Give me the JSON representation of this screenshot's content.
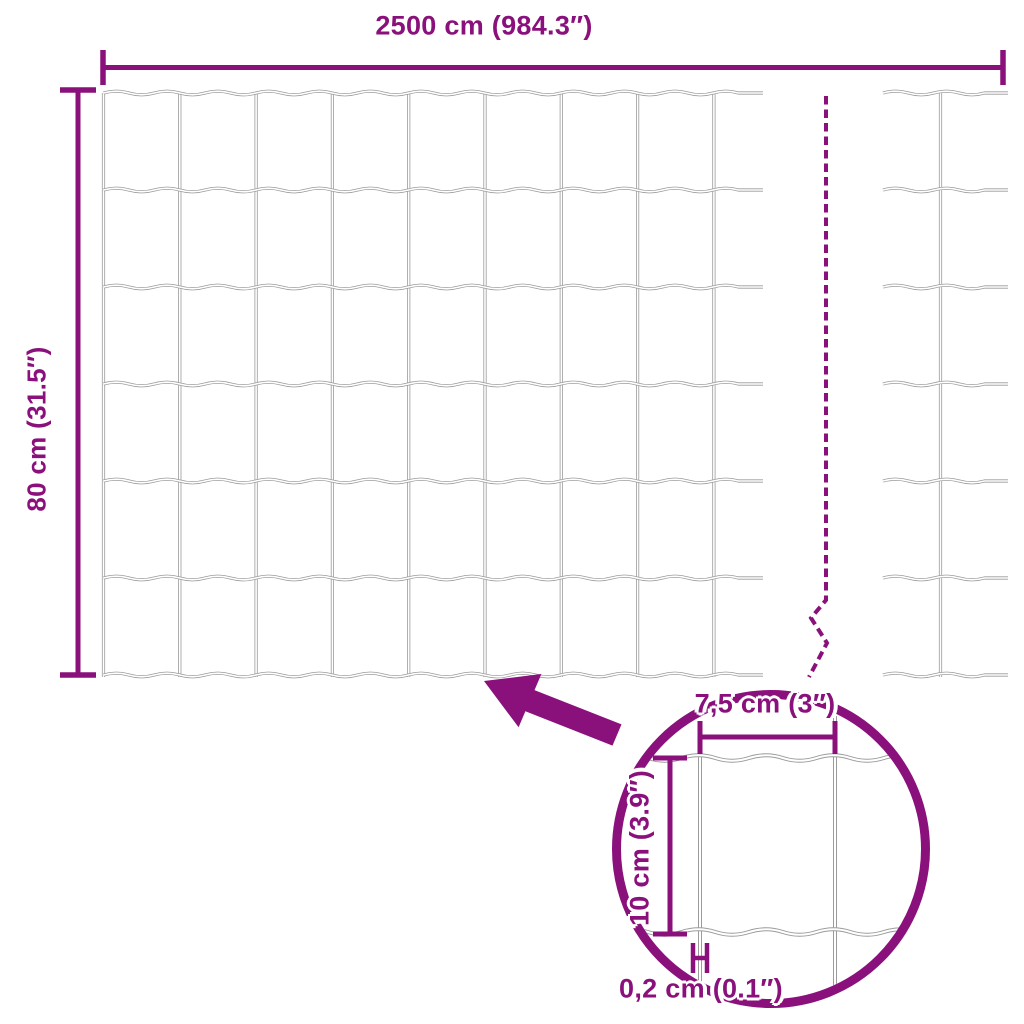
{
  "colors": {
    "accent": "#8A107B",
    "wire": "#9B9B9B",
    "background": "#FFFFFF"
  },
  "overall_dimensions": {
    "width_label": "2500 cm (984.3″)",
    "height_label": "80 cm (31.5″)"
  },
  "detail_view": {
    "mesh_opening_width_label": "7,5 cm (3″)",
    "mesh_opening_height_label": "10 cm (3.9″)",
    "wire_thickness_label": "0,2 cm (0.1″)"
  },
  "icons": {
    "zoom_arrow": "zoom-callout-arrow-icon",
    "break_line": "mesh-break-dashed-line"
  }
}
